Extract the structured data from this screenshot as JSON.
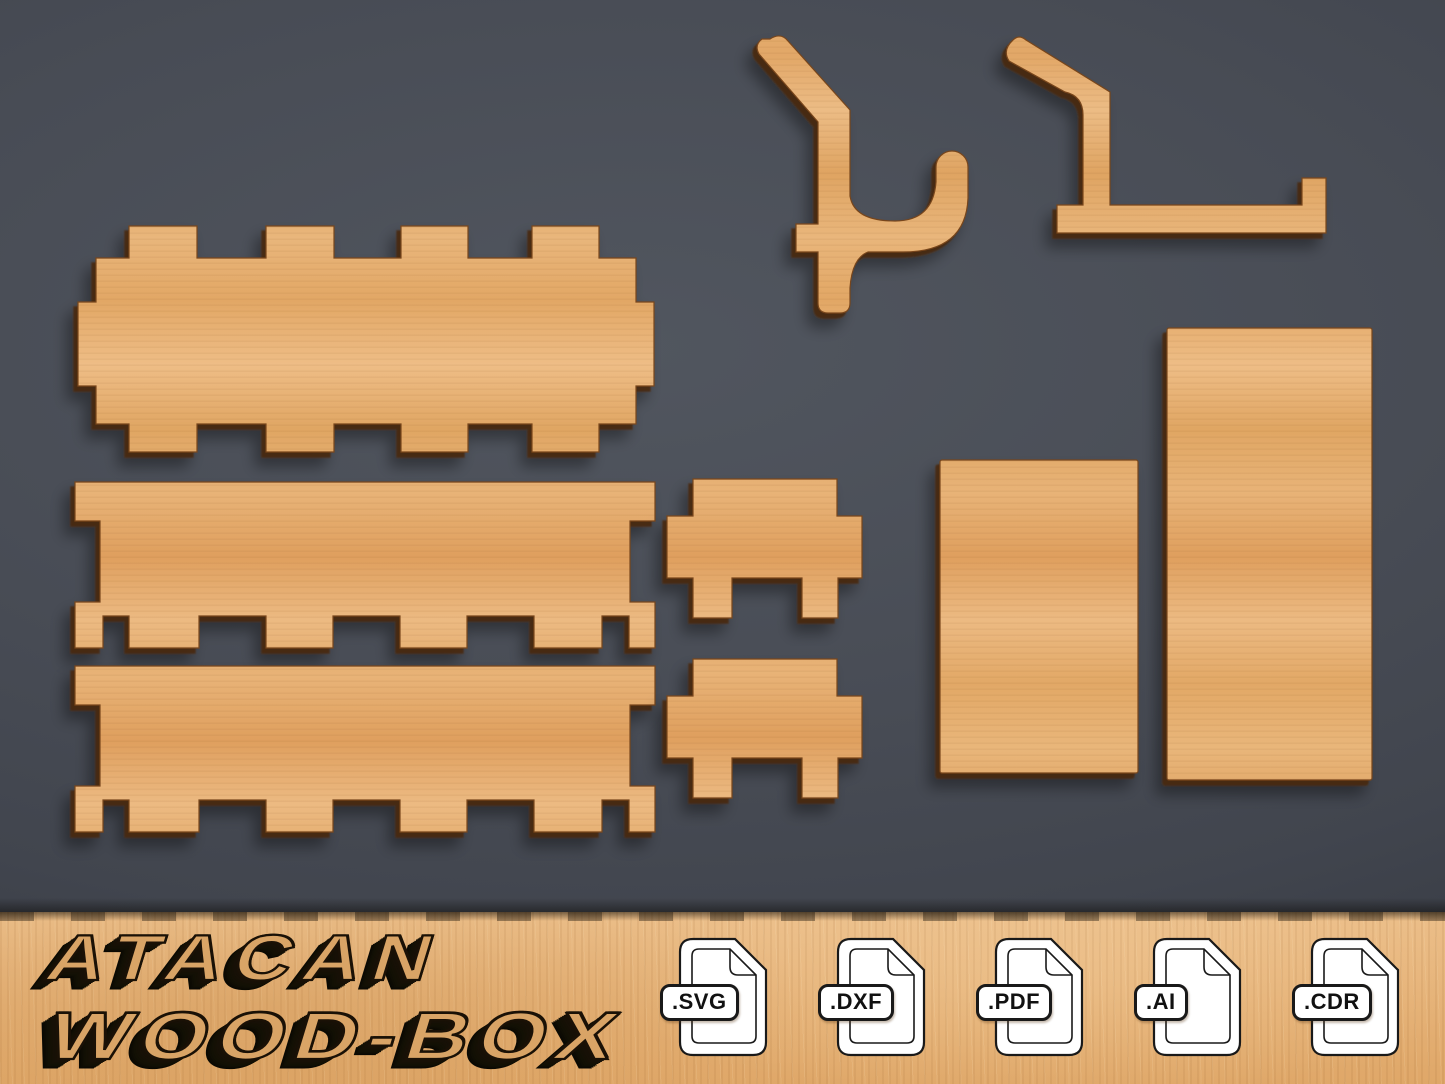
{
  "brand": {
    "line1": "ATACAN",
    "line2": "WOOD-BOX"
  },
  "formats": [
    {
      "label": ".SVG"
    },
    {
      "label": ".DXF"
    },
    {
      "label": ".PDF"
    },
    {
      "label": ".AI"
    },
    {
      "label": ".CDR"
    }
  ],
  "pieces": [
    {
      "name": "box-base-panel-finger-joints",
      "shape": "long panel, tabs on all four sides"
    },
    {
      "name": "side-panel-long-top",
      "shape": "long panel, straight top, toothed bottom, notched ends"
    },
    {
      "name": "side-panel-long-bottom",
      "shape": "long panel, straight top, toothed bottom, notched ends"
    },
    {
      "name": "end-panel-small-top",
      "shape": "small cross-shaped end panel"
    },
    {
      "name": "end-panel-small-bottom",
      "shape": "small cross-shaped end panel"
    },
    {
      "name": "plain-rectangle-short",
      "shape": "plain rectangle"
    },
    {
      "name": "plain-rectangle-tall",
      "shape": "plain rectangle"
    },
    {
      "name": "pegboard-hook-curved",
      "shape": "pegboard hook with curved J arm"
    },
    {
      "name": "pegboard-hook-l-shaped",
      "shape": "pegboard hook with long L shelf arm"
    }
  ],
  "colors": {
    "background": "#474b54",
    "wood": "#e6b176",
    "wood_dark_edge": "#6b3a12",
    "banner_wood": "#e5b176",
    "icon_outline": "#191919",
    "text_extrude": "#14100a"
  }
}
